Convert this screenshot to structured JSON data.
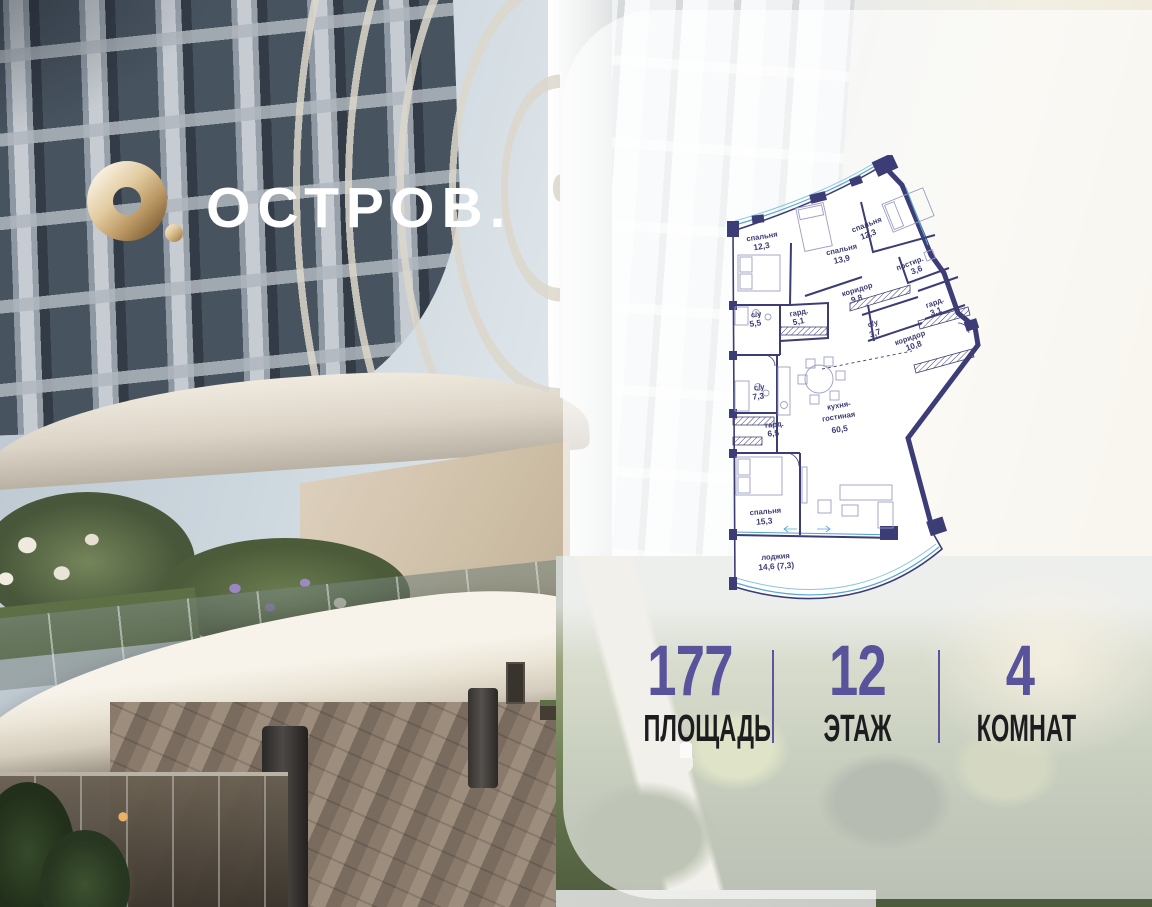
{
  "brand": {
    "name": "ОСТРОВ."
  },
  "floorplan": {
    "rooms": [
      {
        "name": "спальня",
        "area": "12,3"
      },
      {
        "name": "спальня",
        "area": "13,9"
      },
      {
        "name": "спальня",
        "area": "12,3"
      },
      {
        "name": "постир.",
        "area": "3,6"
      },
      {
        "name": "коридор",
        "area": "9,8"
      },
      {
        "name": "гард.",
        "area": "3,1"
      },
      {
        "name": "с/у",
        "area": "5,5"
      },
      {
        "name": "гард.",
        "area": "5,1"
      },
      {
        "name": "с/у",
        "area": "3,7"
      },
      {
        "name": "коридор",
        "area": "10,8"
      },
      {
        "name": "с/у",
        "area": "7,3"
      },
      {
        "name": "гард.",
        "area": "6,5"
      },
      {
        "name": "кухня-",
        "name2": "гостиная",
        "area": "60,5"
      },
      {
        "name": "спальня",
        "area": "15,3"
      },
      {
        "name": "лоджия",
        "area": "14,6 (7,3)"
      }
    ]
  },
  "stats": {
    "items": [
      {
        "value": "177",
        "label": "ПЛОЩАДЬ"
      },
      {
        "value": "12",
        "label": "ЭТАЖ"
      },
      {
        "value": "4",
        "label": "КОМНАТ"
      }
    ]
  },
  "colors": {
    "plan_line": "#3c3c76",
    "glazing_blue": "#57a7d2",
    "accent_purple": "#59539b",
    "logo_gold": "#d9bf94"
  }
}
